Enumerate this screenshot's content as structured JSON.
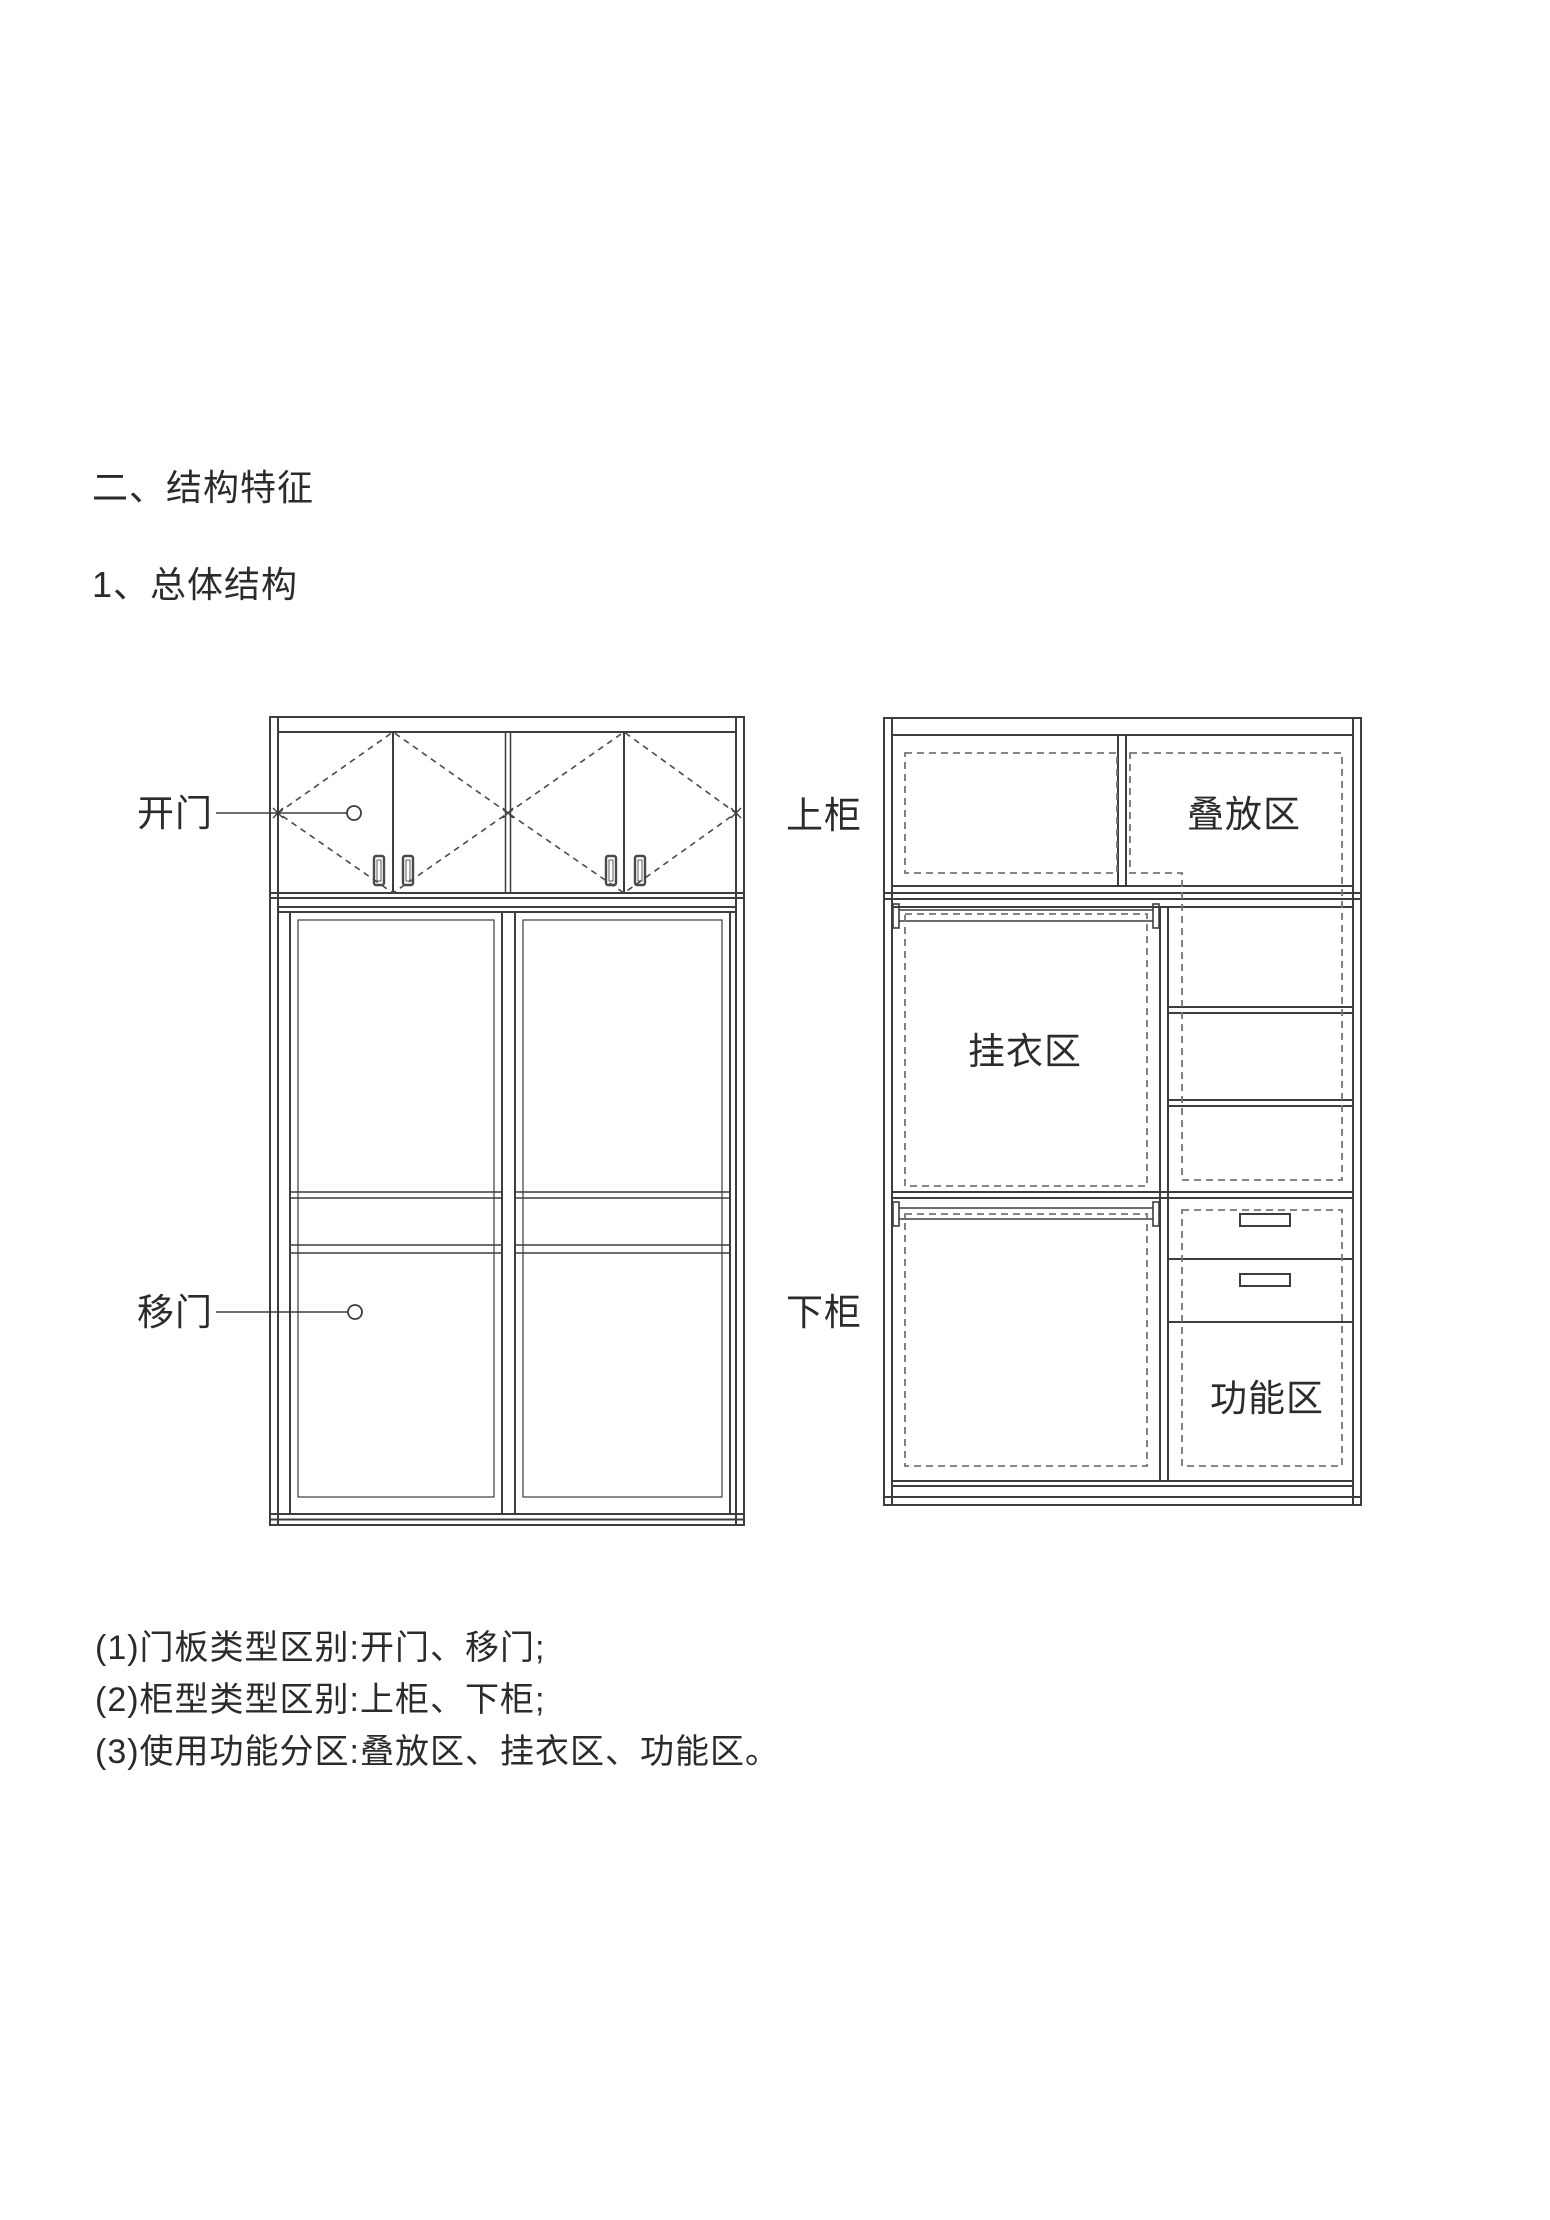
{
  "headings": {
    "section": "二、结构特征",
    "subsection": "1、总体结构"
  },
  "left_diagram": {
    "label_open_door": "开门",
    "label_sliding_door": "移门"
  },
  "right_diagram": {
    "label_upper_cabinet": "上柜",
    "label_lower_cabinet": "下柜",
    "label_stacking_area": "叠放区",
    "label_hanging_area": "挂衣区",
    "label_functional_area": "功能区"
  },
  "notes": [
    "(1)门板类型区别:开门、移门;",
    "(2)柜型类型区别:上柜、下柜;",
    "(3)使用功能分区:叠放区、挂衣区、功能区。"
  ],
  "colors": {
    "line": "#3d3d3d",
    "dashed": "#757575",
    "text": "#2b2b2b",
    "background": "#ffffff"
  }
}
